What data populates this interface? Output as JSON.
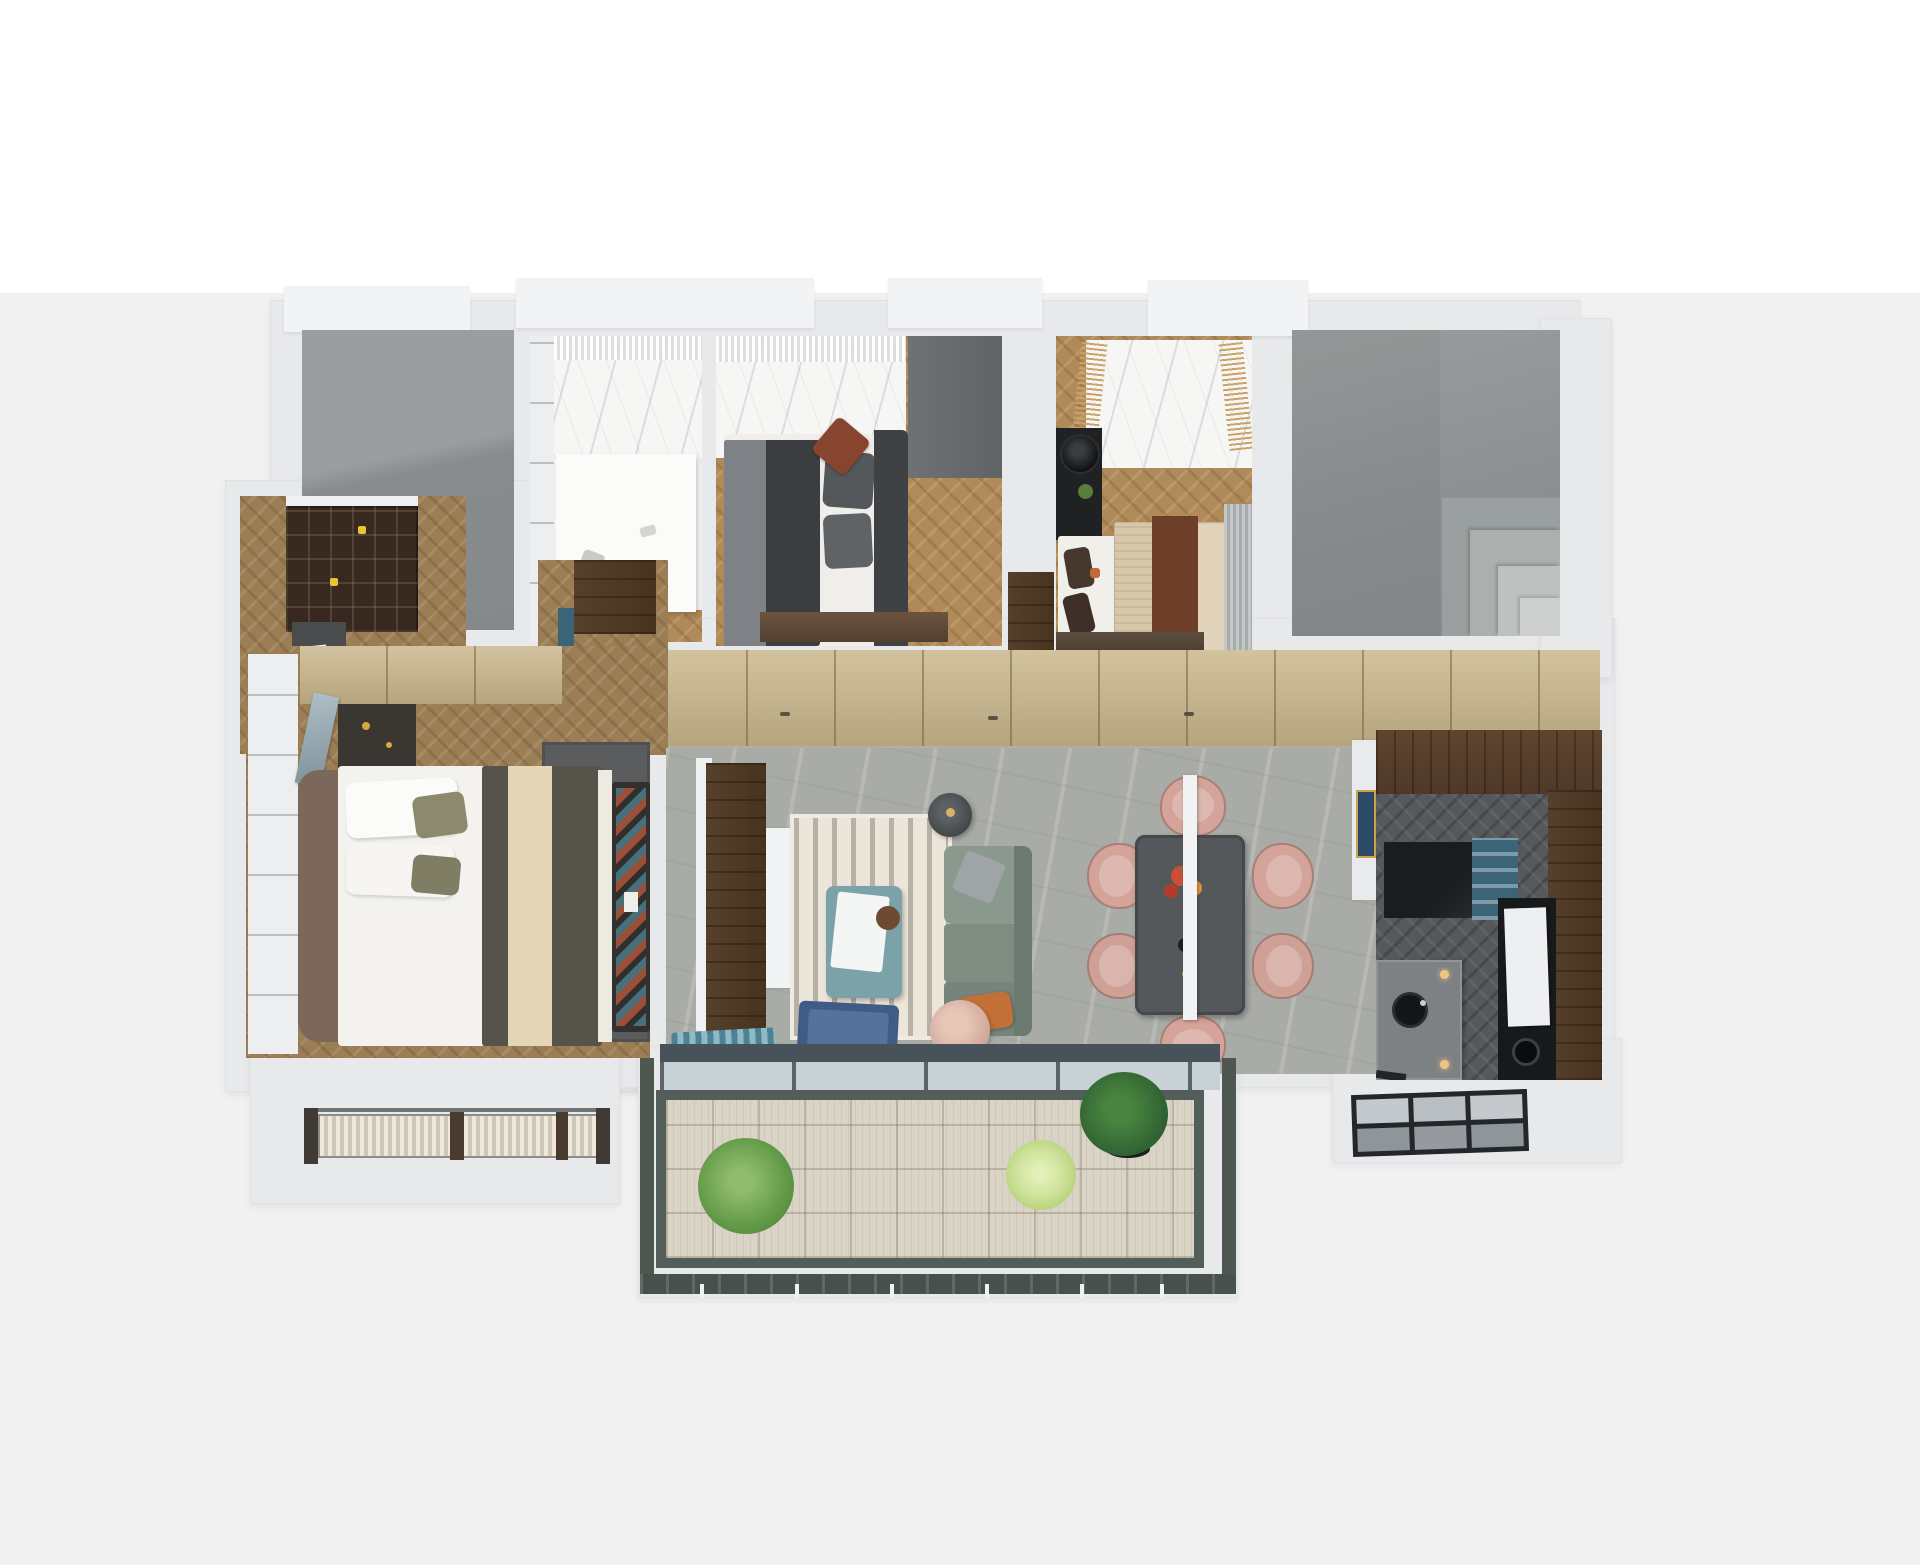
{
  "scene": {
    "type": "3d-floor-plan-render",
    "view": "top-down axonometric apartment visualization",
    "text_content": "none (image contains no text)",
    "background_top": "#ffffff",
    "background_bottom": "#f1f1f2"
  },
  "palette": {
    "wall": "#e8e9eb",
    "wall_bright": "#f2f3f4",
    "gray_room": "#929596",
    "gray_room_dark": "#878a8b",
    "marble_light": "#f6f6f4",
    "marble_gray_floor": "#a9aba6",
    "wood_light": "#b08a58",
    "wood_entry": "#9c7e55",
    "wood_kitchen_dark": "#56585b",
    "cabinet_beige": "#c6b187",
    "cabinet_blue": "#3b6478",
    "counter_walnut": "#5a4233",
    "tv_wall_walnut": "#4a382b",
    "rug_cream": "#ece6da",
    "rug_master_gray": "#5b5c5e",
    "sofa_sage": "#7e8c82",
    "sofa_sage_light": "#8b988e",
    "coffee_table_teal": "#7ba2a8",
    "dining_table_gray": "#55585a",
    "chair_blush": "#d4a49a",
    "pouf_blush": "#d9b4a8",
    "armchair_navy": "#3f5c86",
    "pillow_orange": "#c27038",
    "duvet_dark": "#3b3d40",
    "duvet_olive": "#55534a",
    "duvet_cream_stripe": "#e6d6b8",
    "bed_tan": "#d8c8ab",
    "throw_brown": "#6e3f28",
    "headboard_brown": "#7b685a",
    "bench_dark": "#32312f",
    "bookshelf_brown": "#37291f",
    "deck_wood": "#dad4c7",
    "railing_green_gray": "#535d59",
    "balcony_stone": "#4d564f",
    "glass_pane": "#c8d2d6",
    "plant_green": "#629a48",
    "plant_light_green": "#a9c86a",
    "plant_dark_green": "#2f6132",
    "appliance_black": "#17191b",
    "island_stone": "#7e8183",
    "art_navy": "#2c4a66"
  },
  "rooms": [
    {
      "id": "utility-room",
      "name": "unfinished gray room (top left)"
    },
    {
      "id": "walk-in-closet",
      "name": "walk-in closet / dressing room",
      "furniture": [
        "marble window bay with sheer curtain",
        "white island counter",
        "desk chair"
      ]
    },
    {
      "id": "bedroom-2",
      "name": "second bedroom",
      "furniture": [
        "double bed with dark duvet",
        "gray throw",
        "pillows",
        "rust accent pillow",
        "dark headboard",
        "foot bench",
        "tall gray wardrobe",
        "marble window bay"
      ]
    },
    {
      "id": "bedroom-3",
      "name": "third bedroom",
      "furniture": [
        "double bed with tan cover",
        "brown throw",
        "black nightstand with lamp and plant",
        "gray curtain",
        "low dresser",
        "marble window bay with tan fringe drapes"
      ]
    },
    {
      "id": "stair-core",
      "name": "gray core with corner steps"
    },
    {
      "id": "hallway",
      "name": "hallway with full-height wardrobe wall",
      "furniture": [
        "beige cabinet run",
        "teal entry cabinet",
        "dark timber doors"
      ]
    },
    {
      "id": "study",
      "name": "study / home office",
      "furniture": [
        "dark bookshelf",
        "desk with papers",
        "black office chair",
        "glass partition"
      ]
    },
    {
      "id": "master-bedroom",
      "name": "master bedroom",
      "furniture": [
        "double bed with olive duvet and cream stripe",
        "white pillows",
        "upholstered headboard",
        "foot bench with zigzag runner",
        "dark gray rug",
        "vanity with mirror",
        "white wardrobe",
        "beige cabinets",
        "bay window with shutters"
      ]
    },
    {
      "id": "living-room",
      "name": "living room",
      "furniture": [
        "walnut TV wall",
        "white media unit",
        "cream striped rug",
        "teal coffee table with tray",
        "sage green sofa",
        "gray cushion",
        "orange cushion",
        "charcoal floor lamp",
        "navy armchair",
        "blush pouf",
        "teal fringe throw"
      ]
    },
    {
      "id": "dining-area",
      "name": "dining area",
      "furniture": [
        "dark rectangular table",
        "six blush dining chairs",
        "white linear pendant",
        "red-orange flower centerpiece"
      ]
    },
    {
      "id": "kitchen",
      "name": "kitchen",
      "furniture": [
        "walnut L-shaped counter",
        "black gloss counter",
        "blue open shelf",
        "black appliance column with white fridge",
        "stone island with round sink",
        "gas hob",
        "bar stool",
        "navy art frame at entry"
      ]
    },
    {
      "id": "main-balcony",
      "name": "main balcony",
      "furniture": [
        "timber deck tiles",
        "green shrub",
        "light green grass plant",
        "dark potted plant",
        "glass and metal railing"
      ]
    },
    {
      "id": "service-balcony",
      "name": "service balcony with glazed grid"
    },
    {
      "id": "bay-window",
      "name": "master bay window with shutter slats"
    }
  ]
}
